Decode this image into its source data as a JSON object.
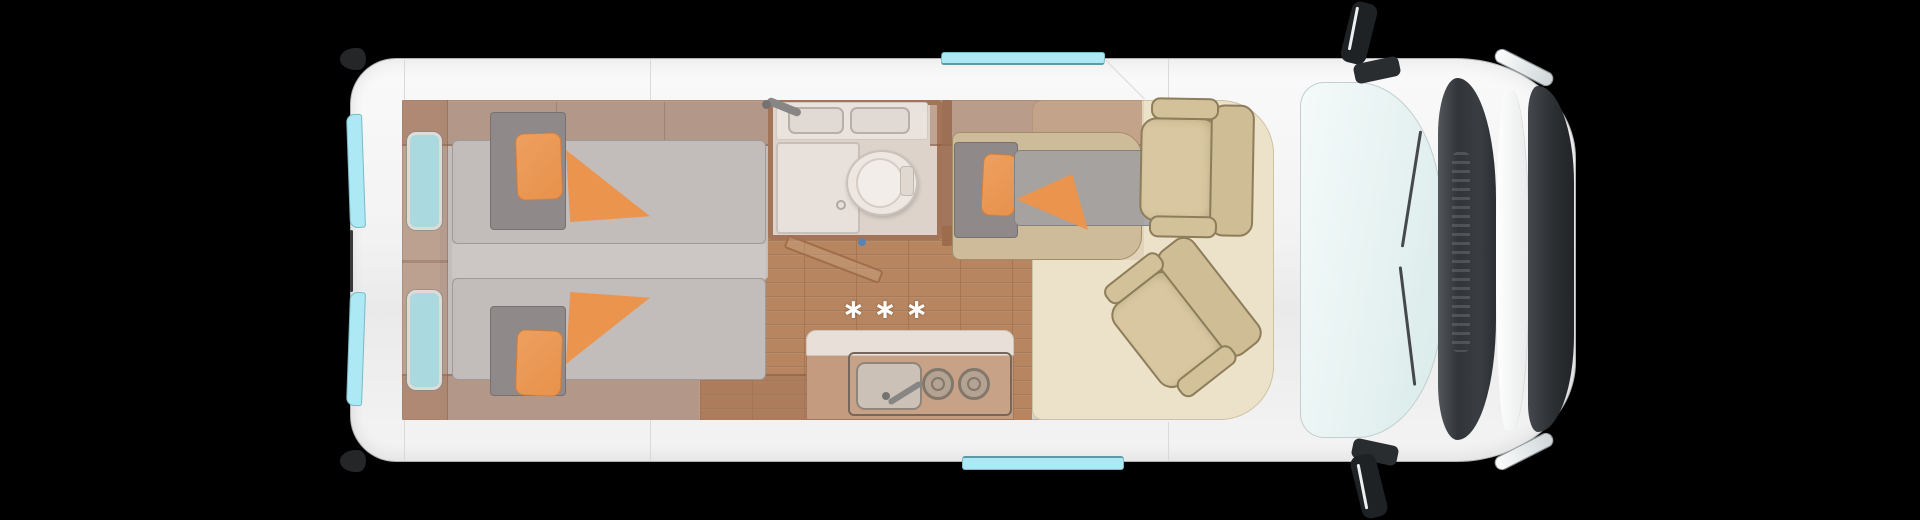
{
  "markers": {
    "stove_flames": "∗∗∗"
  },
  "colors": {
    "background": "#000000",
    "van_body": "#f4f4f4",
    "glass_cyan": "#ace9f4",
    "bedding_orange": "#f79e52",
    "mattress_gray": "#c7c7c9",
    "duvet_gray": "#8d8e90",
    "wood_floor": "#ba8860",
    "cabinet_wood_tint": "#a37458",
    "upholstery_beige": "#d6c6a2",
    "cab_floor_cream": "#ece2ca",
    "front_trim_dark": "#303336"
  }
}
